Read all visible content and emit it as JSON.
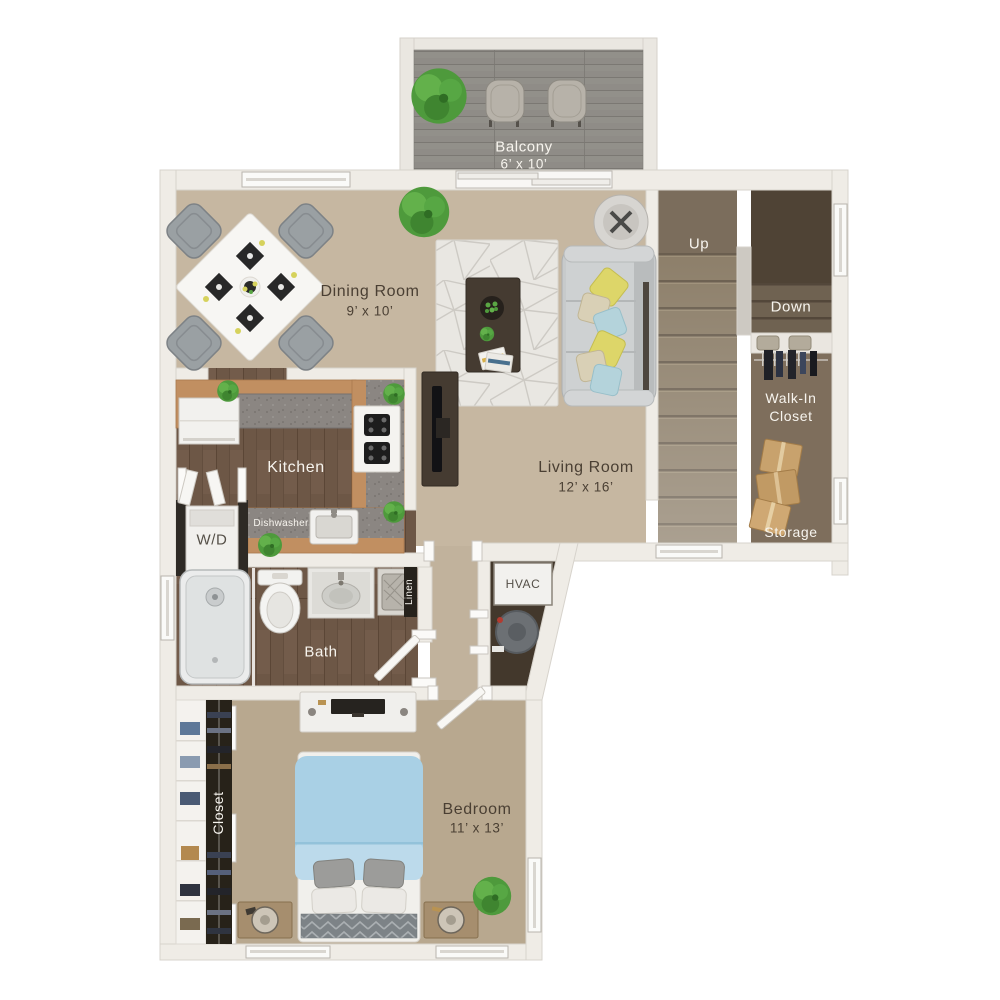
{
  "floorplan": {
    "balcony": {
      "name": "Balcony",
      "dims": "6’ x 10’"
    },
    "dining_room": {
      "name": "Dining Room",
      "dims": "9’ x 10’"
    },
    "kitchen": {
      "name": "Kitchen"
    },
    "living_room": {
      "name": "Living Room",
      "dims": "12’ x 16’"
    },
    "bedroom": {
      "name": "Bedroom",
      "dims": "11’ x 13’"
    },
    "bath": {
      "name": "Bath"
    },
    "stairs": {
      "up": "Up",
      "down": "Down"
    },
    "walk_in_closet": {
      "line1": "Walk-In",
      "line2": "Closet"
    },
    "storage": {
      "name": "Storage"
    },
    "bedroom_closet": {
      "name": "Closet"
    },
    "laundry": {
      "name": "W/D"
    },
    "appliances": {
      "dishwasher": "Dishwasher",
      "hvac": "HVAC"
    },
    "linen": {
      "name": "Linen"
    }
  },
  "colors": {
    "wall": "#efece6",
    "wall_stroke": "#d7d3cc",
    "carpet_main": "#c6b7a1",
    "carpet_bedroom": "#b8a88f",
    "wood_floor": "#6d5746",
    "counter_wood": "#c18f61",
    "countertop_gray": "#8b8682",
    "balcony_deck": "#8f8c87",
    "stair_landing": "#7b6d5c",
    "stair_tread": "#8d7f6a",
    "stairwell_dark": "#4f4335",
    "closet_floor": "#7e6e5c",
    "hvac_floor": "#43382c",
    "rug": "#e9e7e2",
    "sofa": "#c7cacb",
    "bed_duvet": "#a9d0e5",
    "pillow_yellow": "#ddd669",
    "pillow_blue": "#b4d3db",
    "plant_green": "#4e9a3c",
    "box_tan": "#c8a26d",
    "label_dark": "#4a3f33",
    "label_light": "#f7f4ee"
  }
}
